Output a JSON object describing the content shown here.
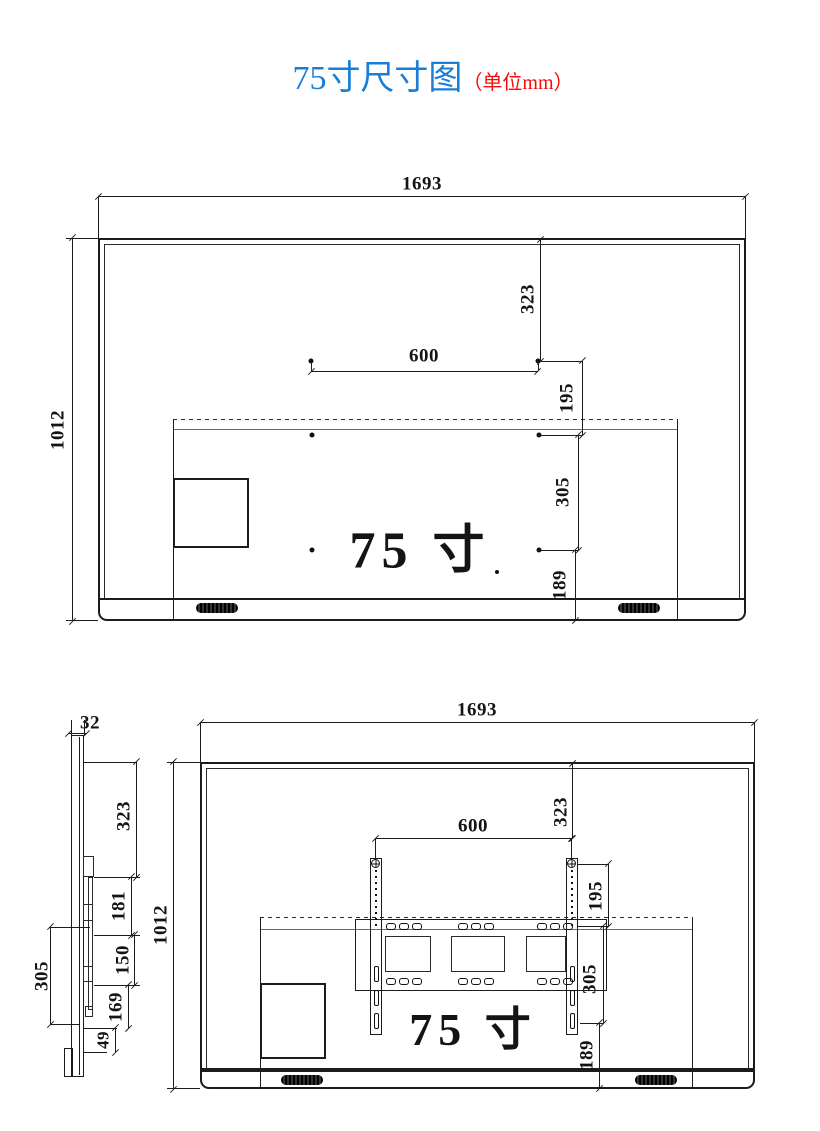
{
  "title": {
    "main": "75寸尺寸图",
    "unit": "（单位mm）"
  },
  "colors": {
    "title_blue": "#1a7ed6",
    "title_red": "#fa0a0c",
    "line": "#1c1c1c"
  },
  "front_view": {
    "size_label": "75 寸",
    "width": "1693",
    "height": "1012",
    "vesa_width": "600",
    "top_to_holes": "323",
    "hole_gap_upper": "195",
    "hole_gap_lower": "305",
    "holes_to_bottom": "189"
  },
  "rear_view": {
    "size_label": "75 寸",
    "width": "1693",
    "height": "1012",
    "vesa_width": "600",
    "top_to_holes": "323",
    "hole_gap_upper": "195",
    "hole_gap_lower": "305",
    "holes_to_bottom": "189"
  },
  "side_view": {
    "thickness": "32",
    "top_to_hook": "323",
    "hook_gap_1": "181",
    "hook_gap_2": "150",
    "hook_gap_3": "169",
    "bottom_gap": "49",
    "bracket_height": "305"
  }
}
